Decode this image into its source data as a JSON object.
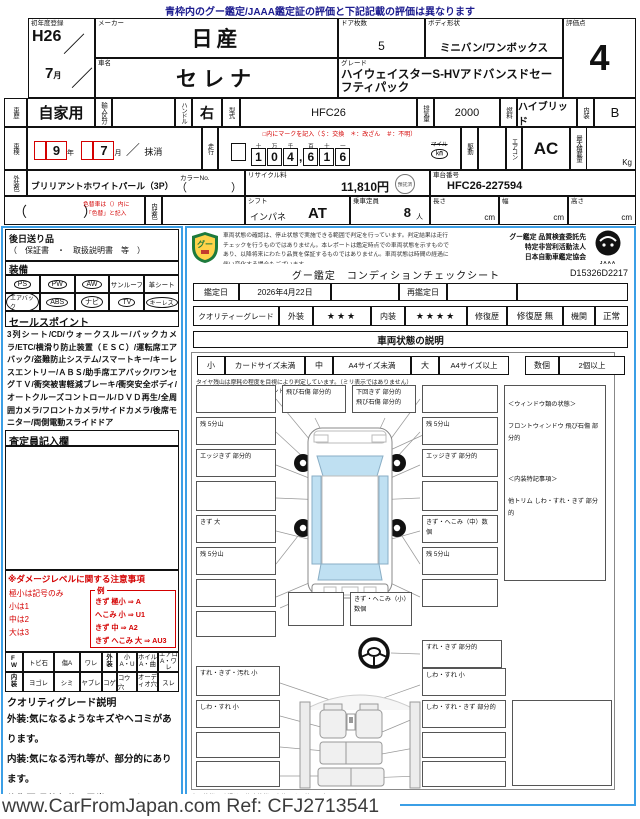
{
  "notice_top": "青枠内のグー鑑定/JAAA鑑定証の評価と下記記載の評価は異なります",
  "watermark": "www.CarFromJapan.com Ref: CFJ2713541",
  "table": {
    "first_reg": {
      "label": "初年度登録",
      "year": "H26",
      "slash": "／",
      "month": "7",
      "month_unit": "月"
    },
    "maker": {
      "label": "メーカー",
      "value": "日産"
    },
    "doors": {
      "label": "ドア枚数",
      "value": "5"
    },
    "body": {
      "label": "ボディ形状",
      "value": "ミニバン/ワンボックス"
    },
    "score": {
      "label": "評価点",
      "value": "4"
    },
    "name": {
      "label": "車名",
      "value": "セレナ"
    },
    "grade": {
      "label": "グレード",
      "value": "ハイウェイスターS-HVアドバンスドセーフティパック"
    },
    "history": {
      "label": "車歴",
      "value": "自家用"
    },
    "import": {
      "label": "輸入区分",
      "value": ""
    },
    "handle": {
      "label": "ハンドル",
      "value": "右"
    },
    "model": {
      "label": "型式",
      "value": "HFC26"
    },
    "displacement": {
      "label": "排気量",
      "value": "2000"
    },
    "fuel": {
      "label": "燃料",
      "value": "ハイブリッド"
    },
    "interior_grade": {
      "label": "内装",
      "value": "B"
    },
    "shaken": {
      "label": "車検",
      "year": "9",
      "year_unit": "年",
      "month": "7",
      "month_unit": "月",
      "slash": "／",
      "note": "抹消"
    },
    "mileage": {
      "label": "走行",
      "mark_note": "□内にマークを記入（＄：交換　＊：改ざん　＃：不明）",
      "places": [
        "十",
        "万",
        "千",
        "百",
        "十",
        "一"
      ],
      "digits": [
        "1",
        "0",
        "4",
        "6",
        "1",
        "6"
      ],
      "comma": ",",
      "unit_top": "マイル",
      "unit_bottom": "㎞"
    },
    "drive": {
      "label": "駆動",
      "value": ""
    },
    "aircon": {
      "label": "エアコン",
      "value": "AC"
    },
    "payload": {
      "label": "最大積載量",
      "unit": "Kg"
    },
    "ext_color": {
      "label": "外装色",
      "value": "ブリリアントホワイトパール（3P）",
      "paren": "（　　　　）",
      "color_no_label": "カラーNo."
    },
    "recycle": {
      "label": "リサイクル料",
      "value": "11,810円",
      "stamp": "預託済"
    },
    "vin": {
      "label": "車台番号",
      "value": "HFC26-227594"
    },
    "repaint": {
      "paren": "（　　　　）",
      "note_line1": "色替車は（）内に",
      "note_line2": "「色替」と記入"
    },
    "int_color": {
      "label": "内装色",
      "value": ""
    },
    "shift": {
      "label": "シフト",
      "type": "インパネ",
      "value": "AT"
    },
    "capacity": {
      "label": "乗車定員",
      "value": "8",
      "unit": "人"
    },
    "length": {
      "label": "長さ",
      "unit": "cm"
    },
    "width": {
      "label": "幅",
      "unit": "cm"
    },
    "height": {
      "label": "高さ",
      "unit": "cm"
    }
  },
  "left": {
    "later_title": "後日送り品",
    "later_items": "（　保証書　・　取扱説明書　等　）",
    "equip_title": "装備",
    "equipment": [
      {
        "label": "PS",
        "circled": true
      },
      {
        "label": "PW",
        "circled": true
      },
      {
        "label": "AW",
        "circled": true
      },
      {
        "label": "サンルーフ",
        "circled": false
      },
      {
        "label": "革シート",
        "circled": false
      },
      {
        "label": "エアバック",
        "circled": true
      },
      {
        "label": "ABS",
        "circled": true
      },
      {
        "label": "ナビ",
        "circled": true
      },
      {
        "label": "TV",
        "circled": true
      },
      {
        "label": "キーレス",
        "circled": true
      }
    ],
    "sales_title": "セールスポイント",
    "sales_text": "3列シート/CD/ウォークスルー/バックカメラ/ETC/横滑り防止装置（ＥＳＣ）/運転席エアバック/盗難防止システム/スマートキー/キーレスエントリー/ＡＢＳ/助手席エアバック/ワンセグＴＶ/衝突被害軽減ブレーキ/衝突安全ボディ/オートクルーズコントロール/ＤＶＤ再生/全周囲カメラ/フロントカメラ/サイドカメラ/後席モニター/両側電動スライドドア",
    "inspector_title": "査定員記入欄",
    "damage": {
      "title": "※ダメージレベルに関する注意事項",
      "legend": [
        "極小は記号のみ",
        "小は1",
        "中は2",
        "大は3"
      ],
      "example_title": "例",
      "examples": [
        "きず 極小 ⇒ A",
        "へこみ 小 ⇒ U1",
        "きず 中 ⇒ A2",
        "きず へこみ 大 ⇒ AU3"
      ]
    },
    "abbrev_row1": [
      "F\nW",
      "トビ石",
      "傷A",
      "ワレ",
      "外\n装",
      "小\nA・U",
      "ホイル\nA・曲",
      "エアロ\nA・ワレ"
    ],
    "abbrev_row2": [
      "内\n装",
      "ヨゴレ",
      "シミ",
      "ヤブレ",
      "コゲ",
      "コウ穴",
      "オーデ\nィオ穴",
      "スレ"
    ],
    "quality_title": "クオリティグレード説明",
    "quality_lines": [
      "外装:気になるようなキズやヘコミがあります。",
      "内装:気になる汚れ等が、部分的にあります。",
      "修復歴:骨格部位に異常はありません。"
    ]
  },
  "sheet": {
    "disclaimer": "車両状態の確認は、停止状態で実施できる範囲で判定を行っています。判定結果は走行チェックを行うものではありません。本レポートは鑑定時点での車両状態を示すものであり、以降将来にわたり品質を保証するものではありません。車両状態は時間の経過に伴い変化する場合もございます。",
    "org_line1": "グー鑑定 品質検査委託先",
    "org_line2": "特定非営利活動法人",
    "org_line3": "日本自動車鑑定協会",
    "goo_logo_text": "グー鑑定",
    "jaaa": "JAAA",
    "title": "グー鑑定　コンディションチェックシート",
    "sheet_no": "D15326D2217",
    "date_label": "鑑定日",
    "date_value": "2026年4月22日",
    "redate_label": "再鑑定日",
    "grade_label": "クオリティーグレード",
    "ext_label": "外装",
    "ext_stars": "★★★",
    "int_label": "内装",
    "int_stars": "★★★★",
    "repair_label": "修復歴",
    "repair_value": "修復歴 無",
    "engine_label": "機関",
    "engine_value": "正常",
    "cond_title": "車両状態の説明",
    "legend": {
      "s": "小",
      "s_desc": "カードサイズ未満",
      "m": "中",
      "m_desc": "A4サイズ未満",
      "l": "大",
      "l_desc": "A4サイズ以上",
      "n": "数個",
      "n_desc": "2個以上"
    },
    "tire_note1": "タイヤ残山は摩耗の程度を目視により判定しています。（ミリ表示ではありません）",
    "tire_note2": "〔例:残 5分山＝概ね50パーセント程度残り溝を示す〕",
    "notes_panel": {
      "win_title": "＜ウィンドウ類の状態＞",
      "win_text": "フロントウィンドウ 飛び石傷 部分的",
      "int_title": "＜内装特記事項＞",
      "int_text": "他トリム しわ・すれ・きず 部分的"
    },
    "diagram": {
      "top": [
        "飛び石傷 部分的",
        "下回きず 部分的\n飛び石傷 部分的"
      ],
      "left": [
        "",
        "残 5分山",
        "エッジきず 部分的",
        "",
        "きず 大",
        "残 5分山",
        ""
      ],
      "right": [
        "",
        "残 5分山",
        "エッジきず 部分的",
        "",
        "きず・へこみ（中）数個",
        "残 5分山",
        ""
      ],
      "bottom": [
        "",
        "",
        "きず・へこみ（小）数個"
      ],
      "steering": "すれ・きず 部分的",
      "int_left": [
        "すれ・きず・汚れ 小",
        "しわ・すれ 小",
        "",
        ""
      ],
      "int_right": [
        "しわ・すれ 小",
        "しわ・すれ・きず 部分的",
        "",
        ""
      ]
    },
    "bottom_note": "車両状態の確認は、停止状態で実施できる範囲で行っています。"
  }
}
